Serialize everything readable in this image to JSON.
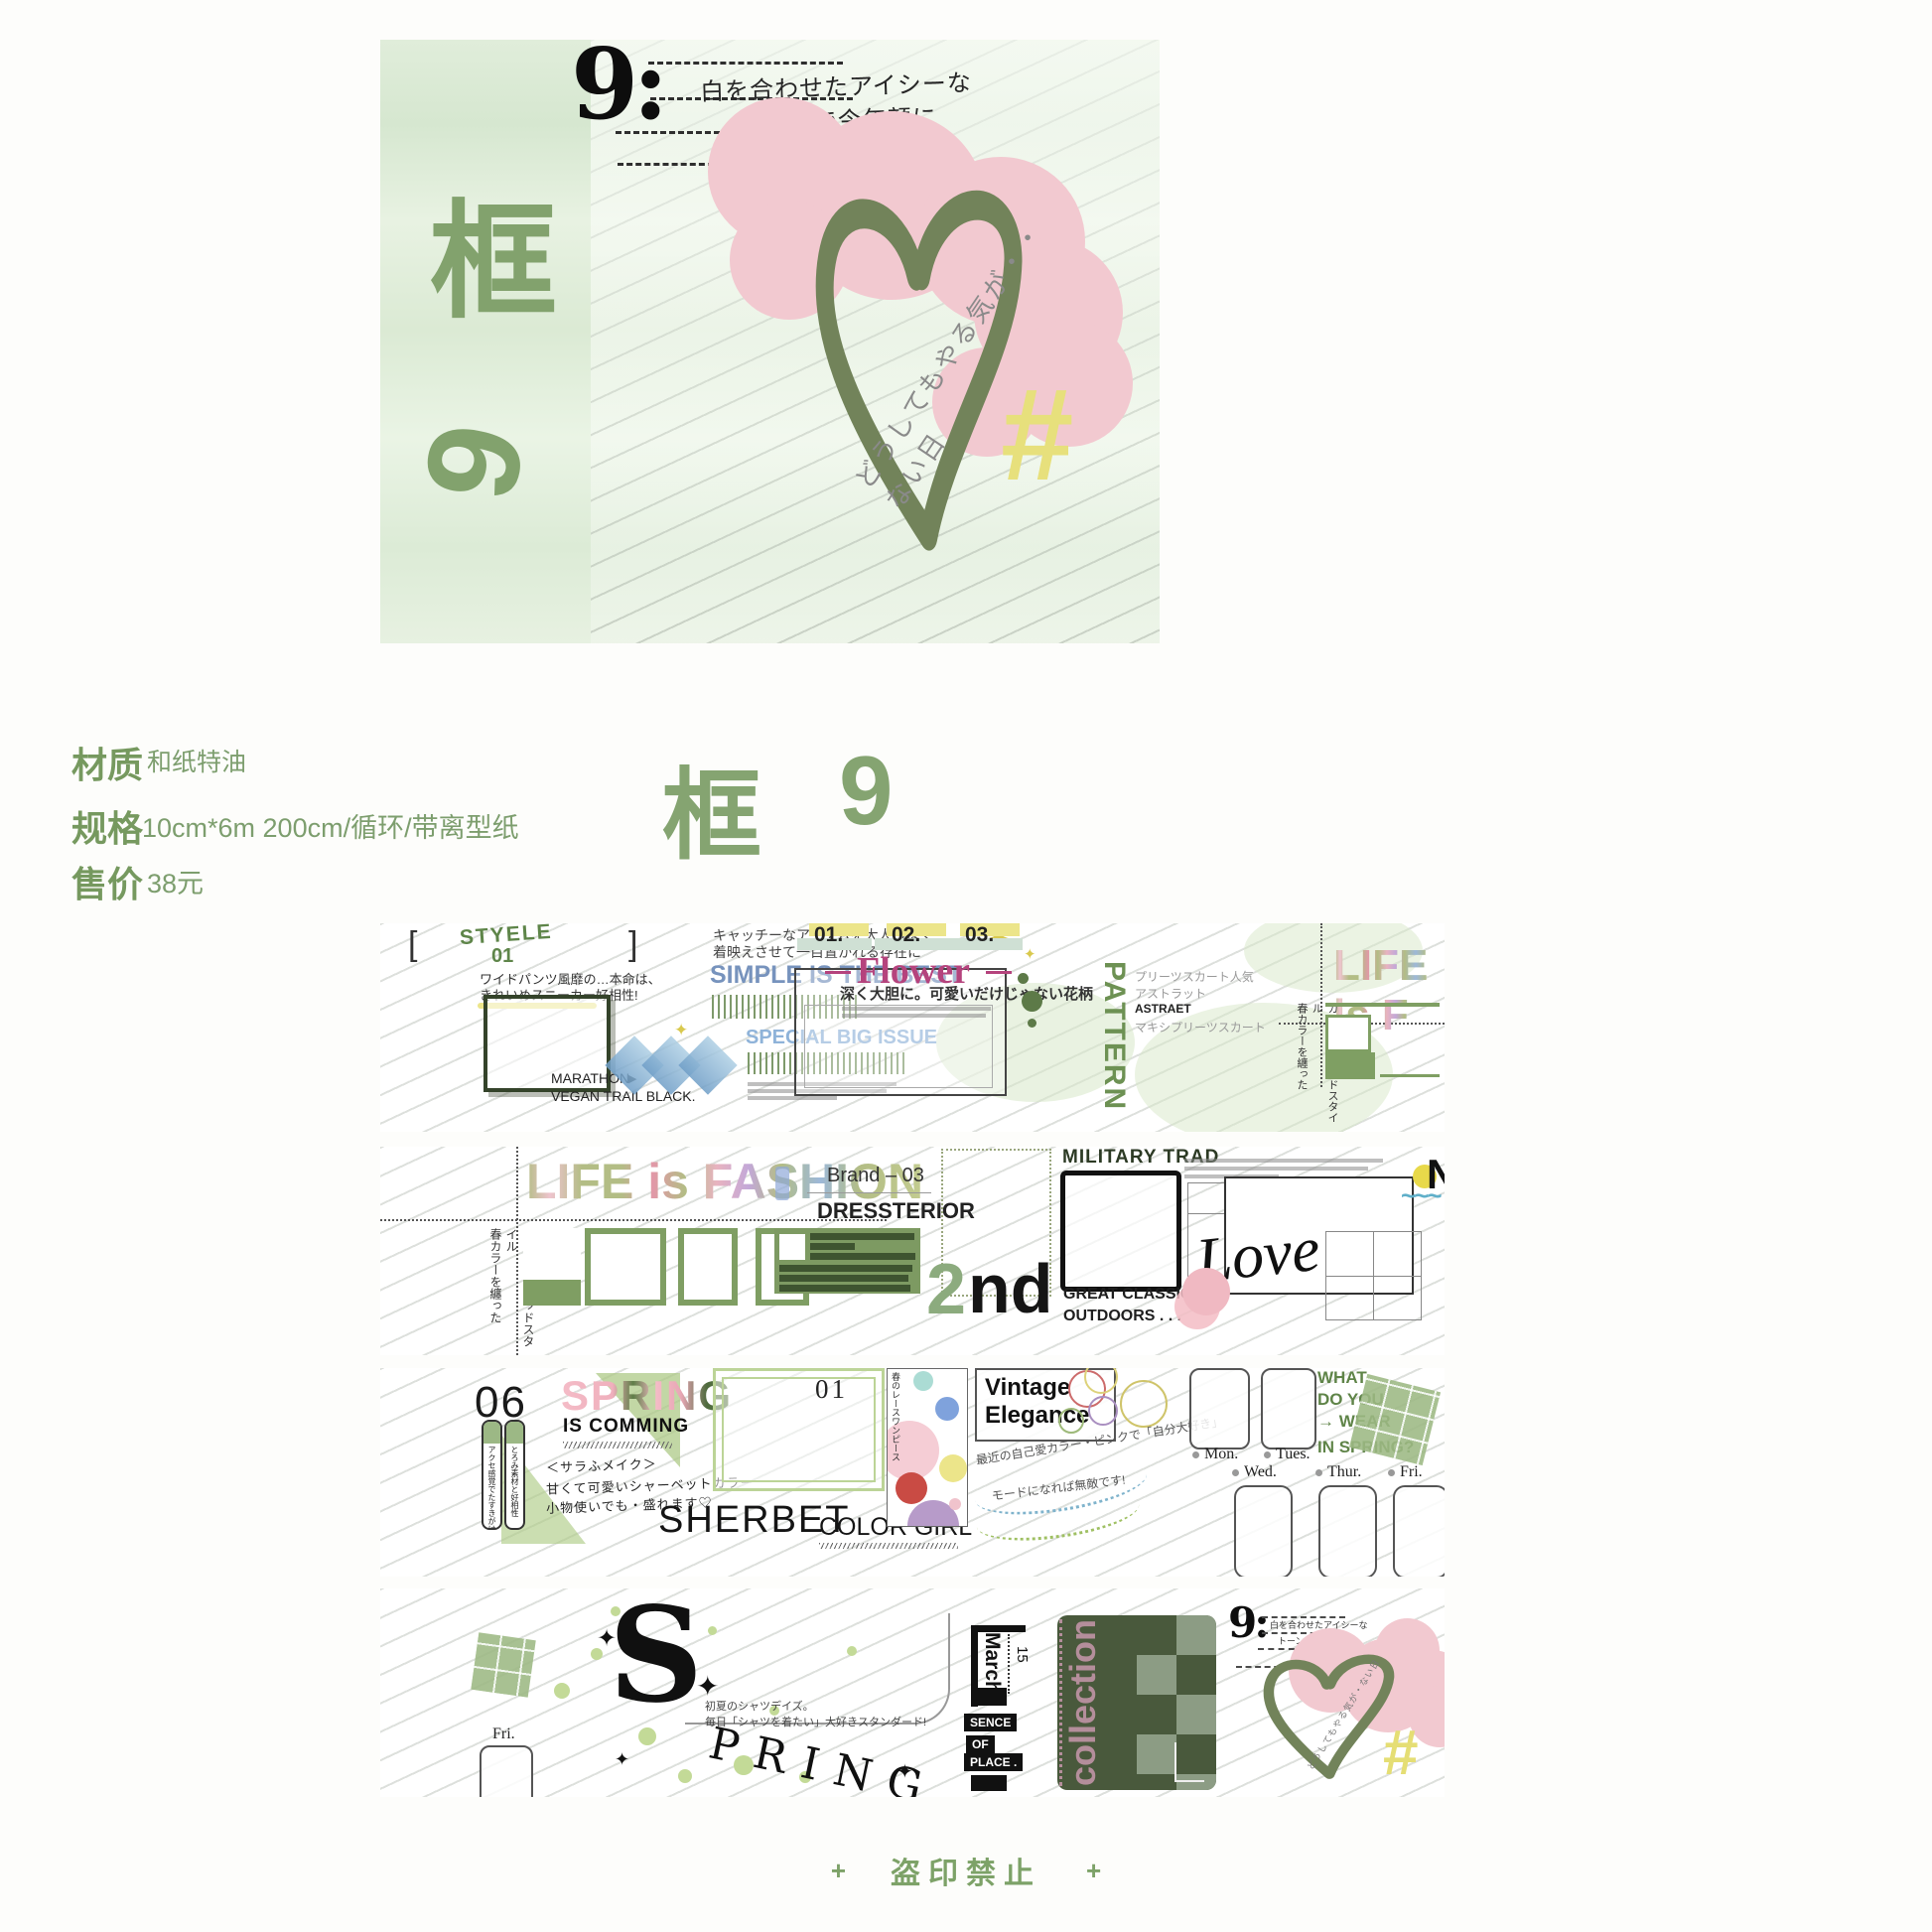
{
  "hero": {
    "frame_char": "框",
    "numeral": "6",
    "bass_clef": "9:",
    "note_line1": "白を合わせたアイシーな",
    "note_line2": "トーンで今年顔に",
    "diagonal_note": "どうしてもやる気が・・ない日",
    "hashtag": "#"
  },
  "product": {
    "material_label": "材质",
    "material_value": "和纸特油",
    "spec_label": "规格",
    "spec_value": "10cm*6m 200cm/循环/带离型纸",
    "price_label": "售价",
    "price_value": "38元",
    "series_char": "框",
    "series_number": "9"
  },
  "tape": {
    "row1": {
      "bracket_open": "[",
      "style_word": "STYELE",
      "style_num": "01",
      "bracket_close": "]",
      "jp_catchy1": "キャッチーなアイテムを大人っぽく",
      "jp_catchy2": "着映えさせて一目置かれる存在に",
      "simple_best": "SIMPLE IS THE BEST",
      "sparkle": "✦",
      "jp_wide1": "ワイドパンツ風靡の…本命は、",
      "jp_wide2": "きれいめスニーカー好相性!",
      "marathon": "MARATHON",
      "arrow": "▶",
      "vegan": "VEGAN TRAIL BLACK.",
      "special_issue": "SPECIAL BIG ISSUE",
      "num1": "01.",
      "num2": "02.",
      "num3": "03.",
      "flower": "Flower",
      "flower_sub": "深く大胆に。可愛いだけじゃない花柄",
      "pattern": "PATTERN",
      "jp_pleats1": "プリーツスカート人気",
      "jp_pleats2": "アストラット",
      "jp_pleats3": "ASTRAET",
      "jp_pleats4": "マキシプリーツスカート",
      "life_partial": "LIFE is F",
      "jp_spring_v1": "春カラーを纏った",
      "jp_spring_v2": "ガールズトラッドスタイル"
    },
    "row2": {
      "life_fashion": "LIFE is FASHION",
      "jp_spring_v1": "春カラーを纏った",
      "jp_spring_v2": "ガールズトラッドスタイル",
      "brand": "Brand – 03",
      "brand_name": "DRESSTERIOR",
      "military": "MILITARY TRAD",
      "second_num": "2",
      "second_suffix": "nd",
      "classic1": "GREAT CLASSIC",
      "classic2": "OUTDOORS . . .",
      "love": "Love",
      "letter_n": "N",
      "sun_waves": "~~~"
    },
    "row3": {
      "num": "06",
      "spring": "SPRING",
      "is_comming": "IS COMMING",
      "jp_hand1": "＜サラふメイク＞",
      "jp_hand2": "甘くて可愛いシャーベットカラー",
      "jp_hand3": "小物使いでも・盛れます♡",
      "tag1": "アクセ感覚でたすきがけ",
      "tag2": "とろみ素材と好相性",
      "frame_num": "01",
      "sherbet": "SHERBET",
      "color_girl": "COLOR GIRL",
      "jp_lace": "春のレースワンピース",
      "vintage": "Vintage",
      "elegance": "Elegance",
      "jp_curve1": "最近の自己愛カラー・ピンクで「自分大好き」",
      "jp_curve2": "モードになれば無敵です!",
      "what1": "WHAT",
      "what2": "DO YOU",
      "what3": "→ WEAR",
      "what4": "IN SPRING?",
      "mon": "Mon.",
      "tues": "Tues.",
      "wed": "Wed.",
      "thur": "Thur.",
      "fri": "Fri."
    },
    "row4": {
      "fri": "Fri.",
      "s_letter": "S",
      "pring": "PRING",
      "star": "✦",
      "jp_shirt1": "初夏のシャツデイズ。",
      "jp_shirt2": "毎日「シャツを着たい」大好きスタンダード!",
      "march": "March",
      "date": "15",
      "sence": "SENCE",
      "of": "OF",
      "place": "PLACE .",
      "collection": "collection",
      "mini_clef": "9:",
      "mini_jp1": "白を合わせたアイシーな",
      "mini_jp2": "トーンで今年顔に",
      "mini_diag": "どうしてもやる気が・ない日",
      "mini_hash": "#"
    }
  },
  "footer": {
    "plus_left": "+",
    "text": "盗印禁止",
    "plus_right": "+"
  }
}
